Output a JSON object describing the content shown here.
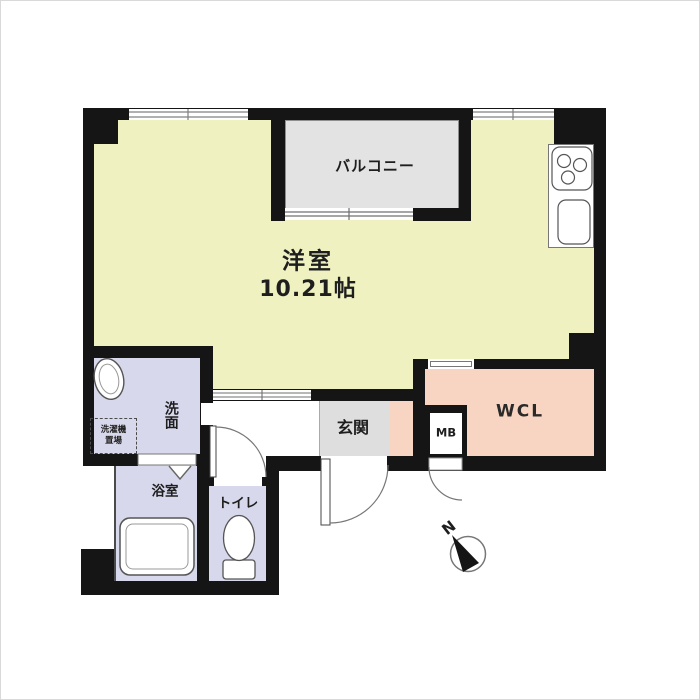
{
  "plan_title": "1R floor plan",
  "rooms": {
    "main": {
      "name": "洋室",
      "size": "10.21帖"
    },
    "balcony": {
      "name": "バルコニー"
    },
    "walk_in_closet": {
      "name": "WCL"
    },
    "entrance": {
      "name": "玄関"
    },
    "meter_box": {
      "name": "MB"
    },
    "washroom": {
      "name": "洗面"
    },
    "laundry_space": {
      "line1": "洗濯機",
      "line2": "置場"
    },
    "bathroom": {
      "name": "浴室"
    },
    "toilet": {
      "name": "トイレ"
    }
  },
  "compass": {
    "label": "N"
  },
  "palette": {
    "wall": "#151515",
    "main_room_fill": "#f0f1c1",
    "balcony_fill": "#e3e3e3",
    "closet_fill": "#f8d5c3",
    "entrance_fill": "#dedede",
    "wet_area_fill": "#d7d8eb",
    "fixture_outline": "#555555"
  }
}
